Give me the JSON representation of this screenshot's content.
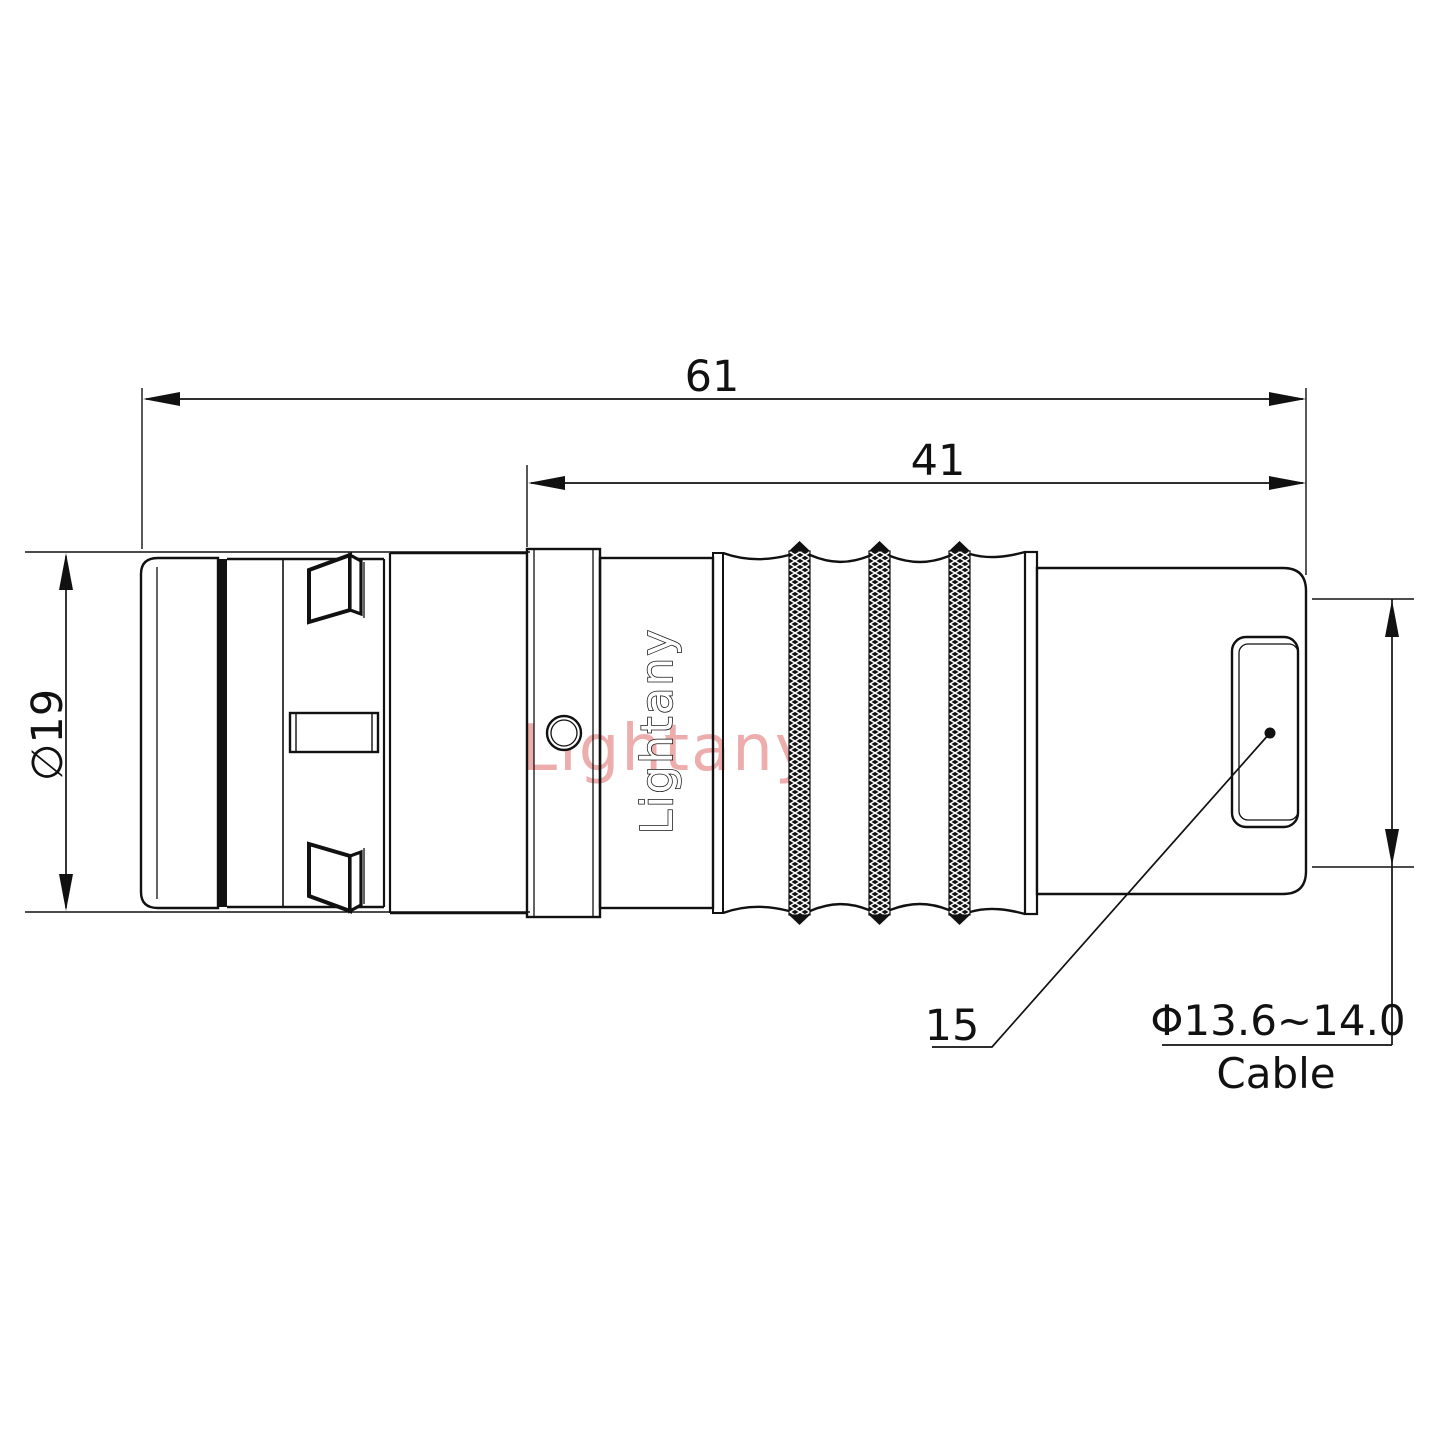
{
  "labels": {
    "overall_length": "61",
    "mid_length": "41",
    "body_diameter": "∅19",
    "rear_ref": "15",
    "cable_range": "Φ13.6~14.0",
    "cable_word": "Cable"
  },
  "branding": {
    "engraving": "Lightany",
    "watermark": "Lightany"
  },
  "colors": {
    "line": "#111111",
    "watermark_pink": "#eeadad",
    "background": "#ffffff",
    "knurl_fill": "#111111"
  }
}
